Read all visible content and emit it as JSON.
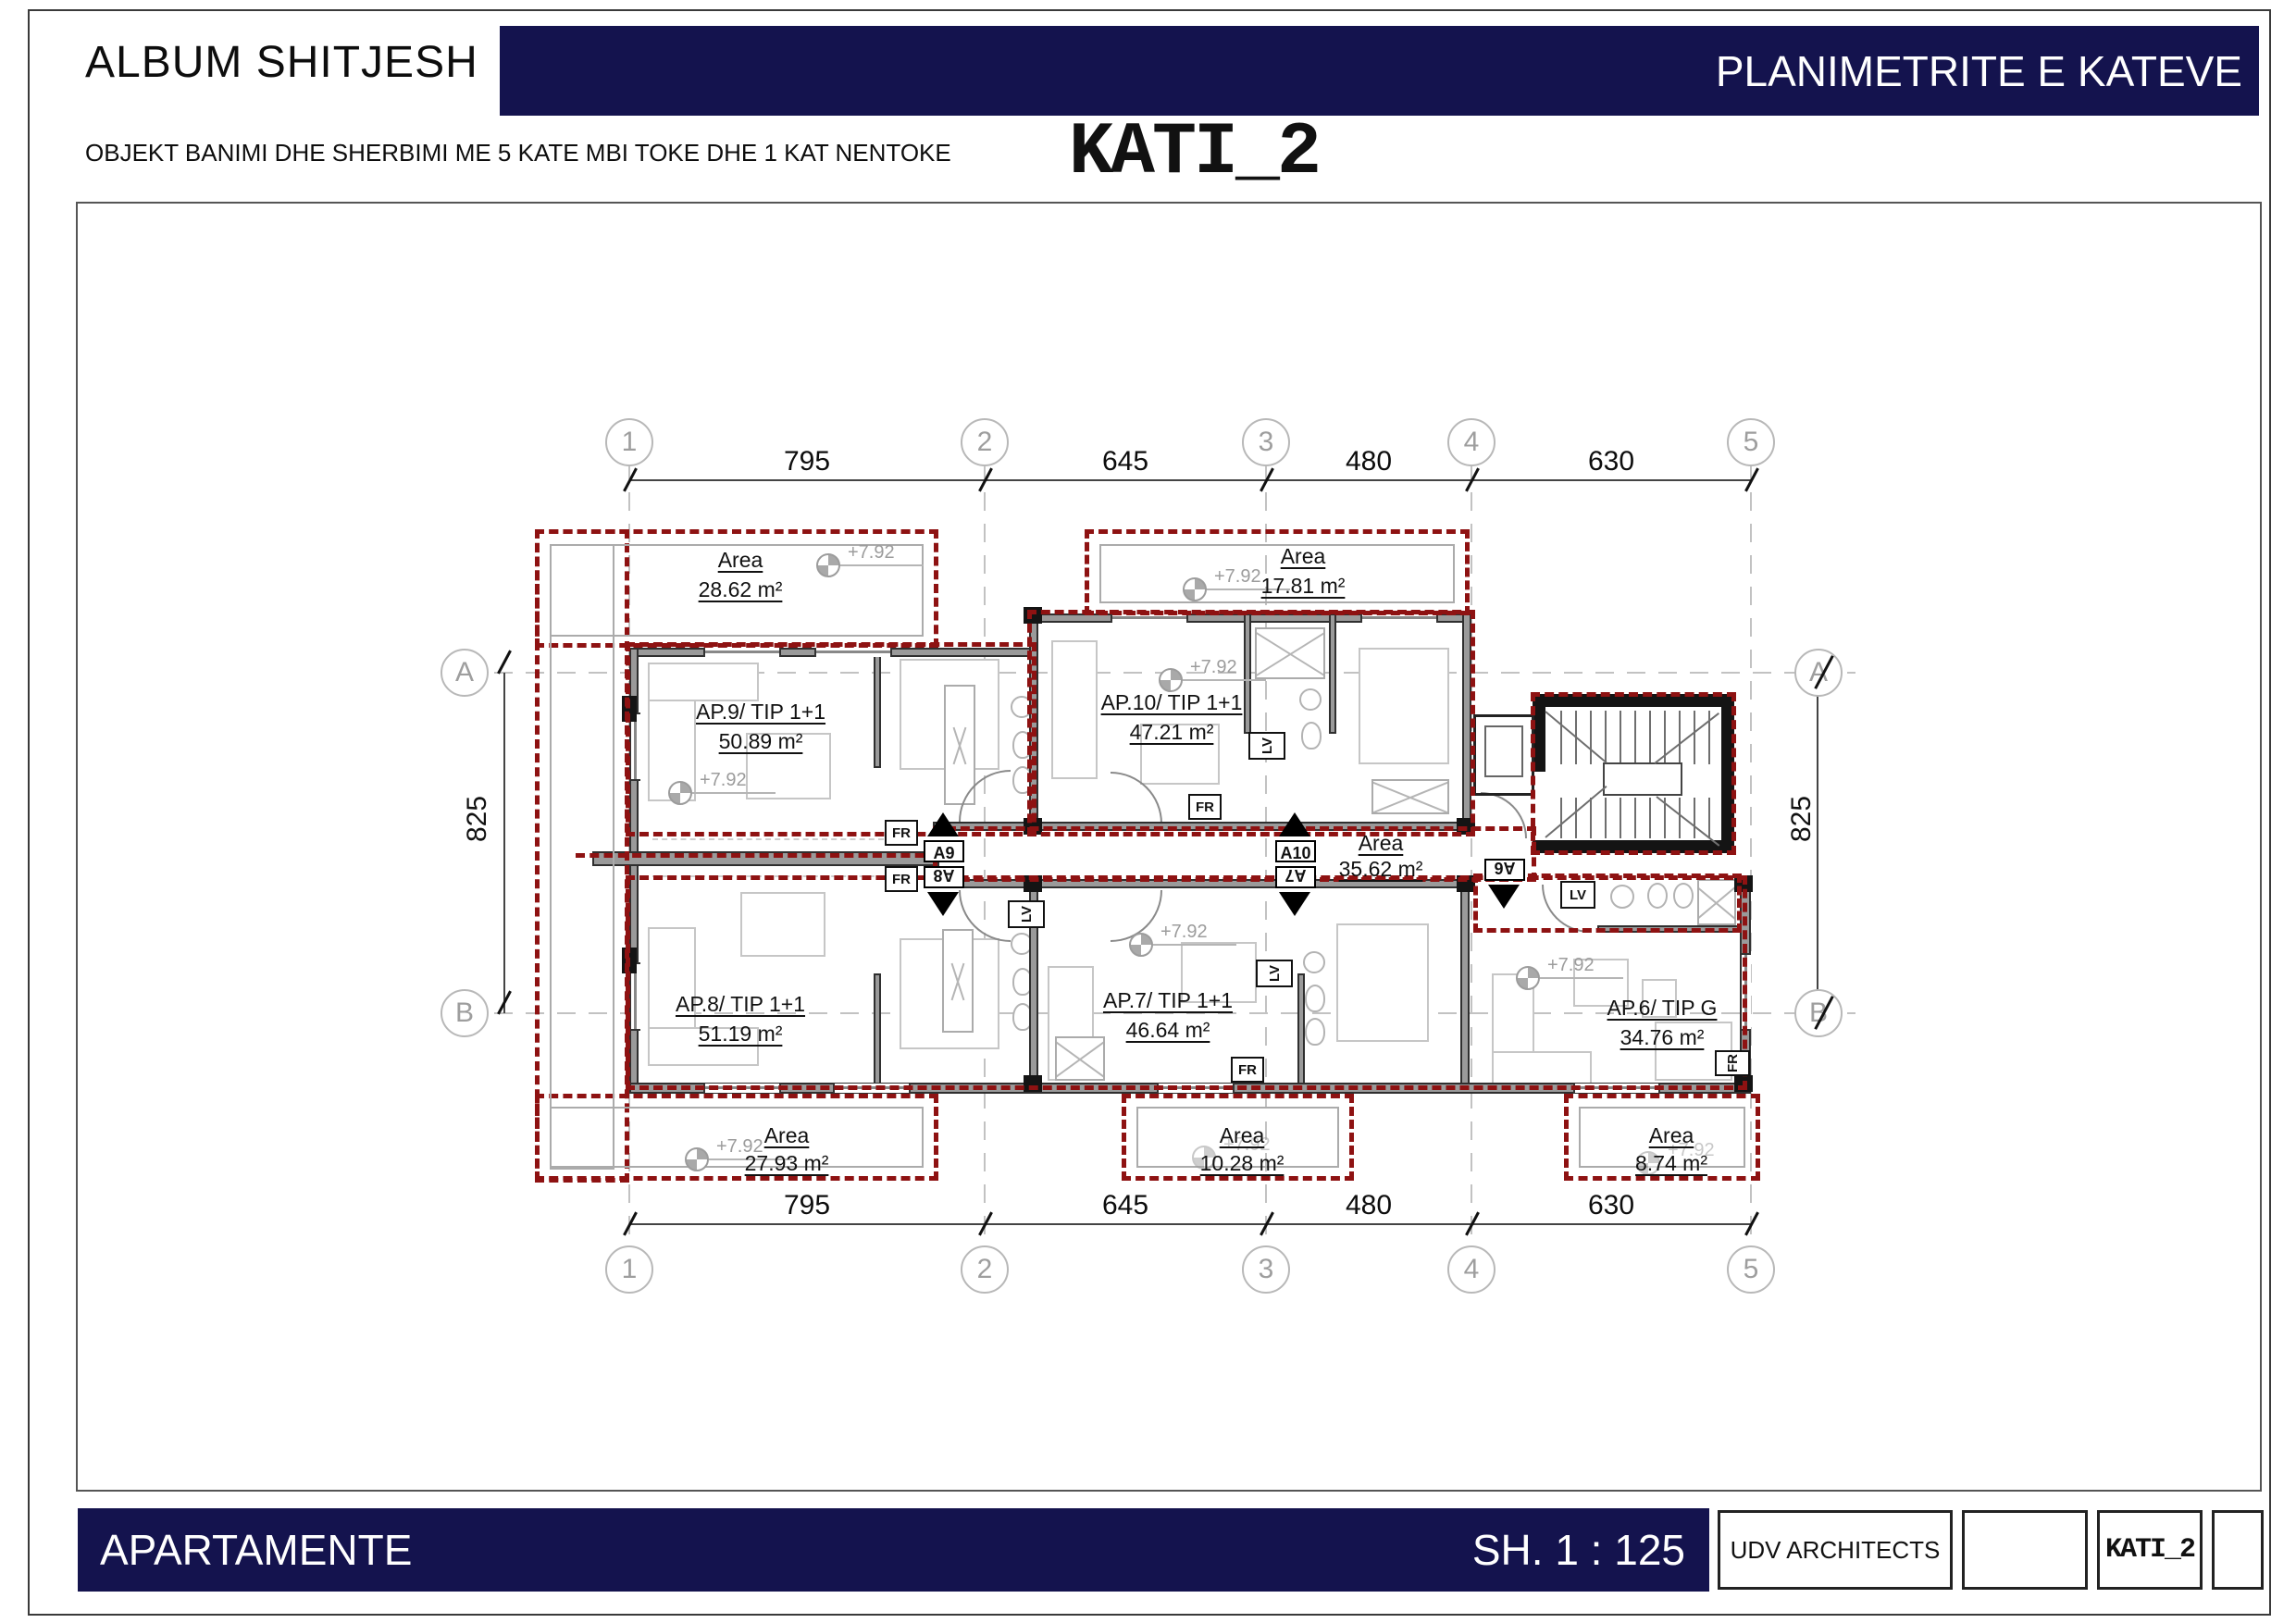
{
  "header": {
    "album_title": "ALBUM SHITJESH",
    "plans_title": "PLANIMETRITE E KATEVE",
    "subtitle": "OBJEKT BANIMI DHE SHERBIMI ME 5 KATE MBI TOKE DHE 1 KAT NENTOKE",
    "floor_title": "KATI_2"
  },
  "footer": {
    "left_label": "APARTAMENTE",
    "scale_label": "SH. 1 : 125",
    "architect_label": "UDV ARCHITECTS",
    "floor_code": "KATI_2"
  },
  "grid": {
    "columns": [
      "1",
      "2",
      "3",
      "4",
      "5"
    ],
    "rows": [
      "A",
      "B"
    ],
    "top_dims": [
      "795",
      "645",
      "480",
      "630"
    ],
    "bottom_dims": [
      "795",
      "645",
      "480",
      "630"
    ],
    "left_dim": "825",
    "right_dim": "825"
  },
  "plan": {
    "elevation_label": "+7.92",
    "area_word": "Area",
    "apartments": [
      {
        "name": "AP.9/ TIP 1+1",
        "area": "50.89 m²"
      },
      {
        "name": "AP.10/ TIP 1+1",
        "area": "47.21 m²"
      },
      {
        "name": "AP.8/ TIP 1+1",
        "area": "51.19 m²"
      },
      {
        "name": "AP.7/ TIP 1+1",
        "area": "46.64 m²"
      },
      {
        "name": "AP.6/ TIP G",
        "area": "34.76 m²"
      }
    ],
    "terraces": [
      {
        "value": "28.62 m²"
      },
      {
        "value": "17.81 m²"
      },
      {
        "value": "27.93 m²"
      },
      {
        "value": "10.28 m²"
      },
      {
        "value": "8.74 m²"
      }
    ],
    "corridor_area": "35.62 m²",
    "markers": {
      "a9": "A9",
      "a8": "A8",
      "a10": "A10",
      "a7": "A7",
      "a6": "A6"
    },
    "appliances": {
      "fridge": "FR",
      "washer": "LV"
    }
  },
  "colors": {
    "navy": "#14134e",
    "red_dash": "#8e1212",
    "wall_gray": "#9a9a9a"
  }
}
